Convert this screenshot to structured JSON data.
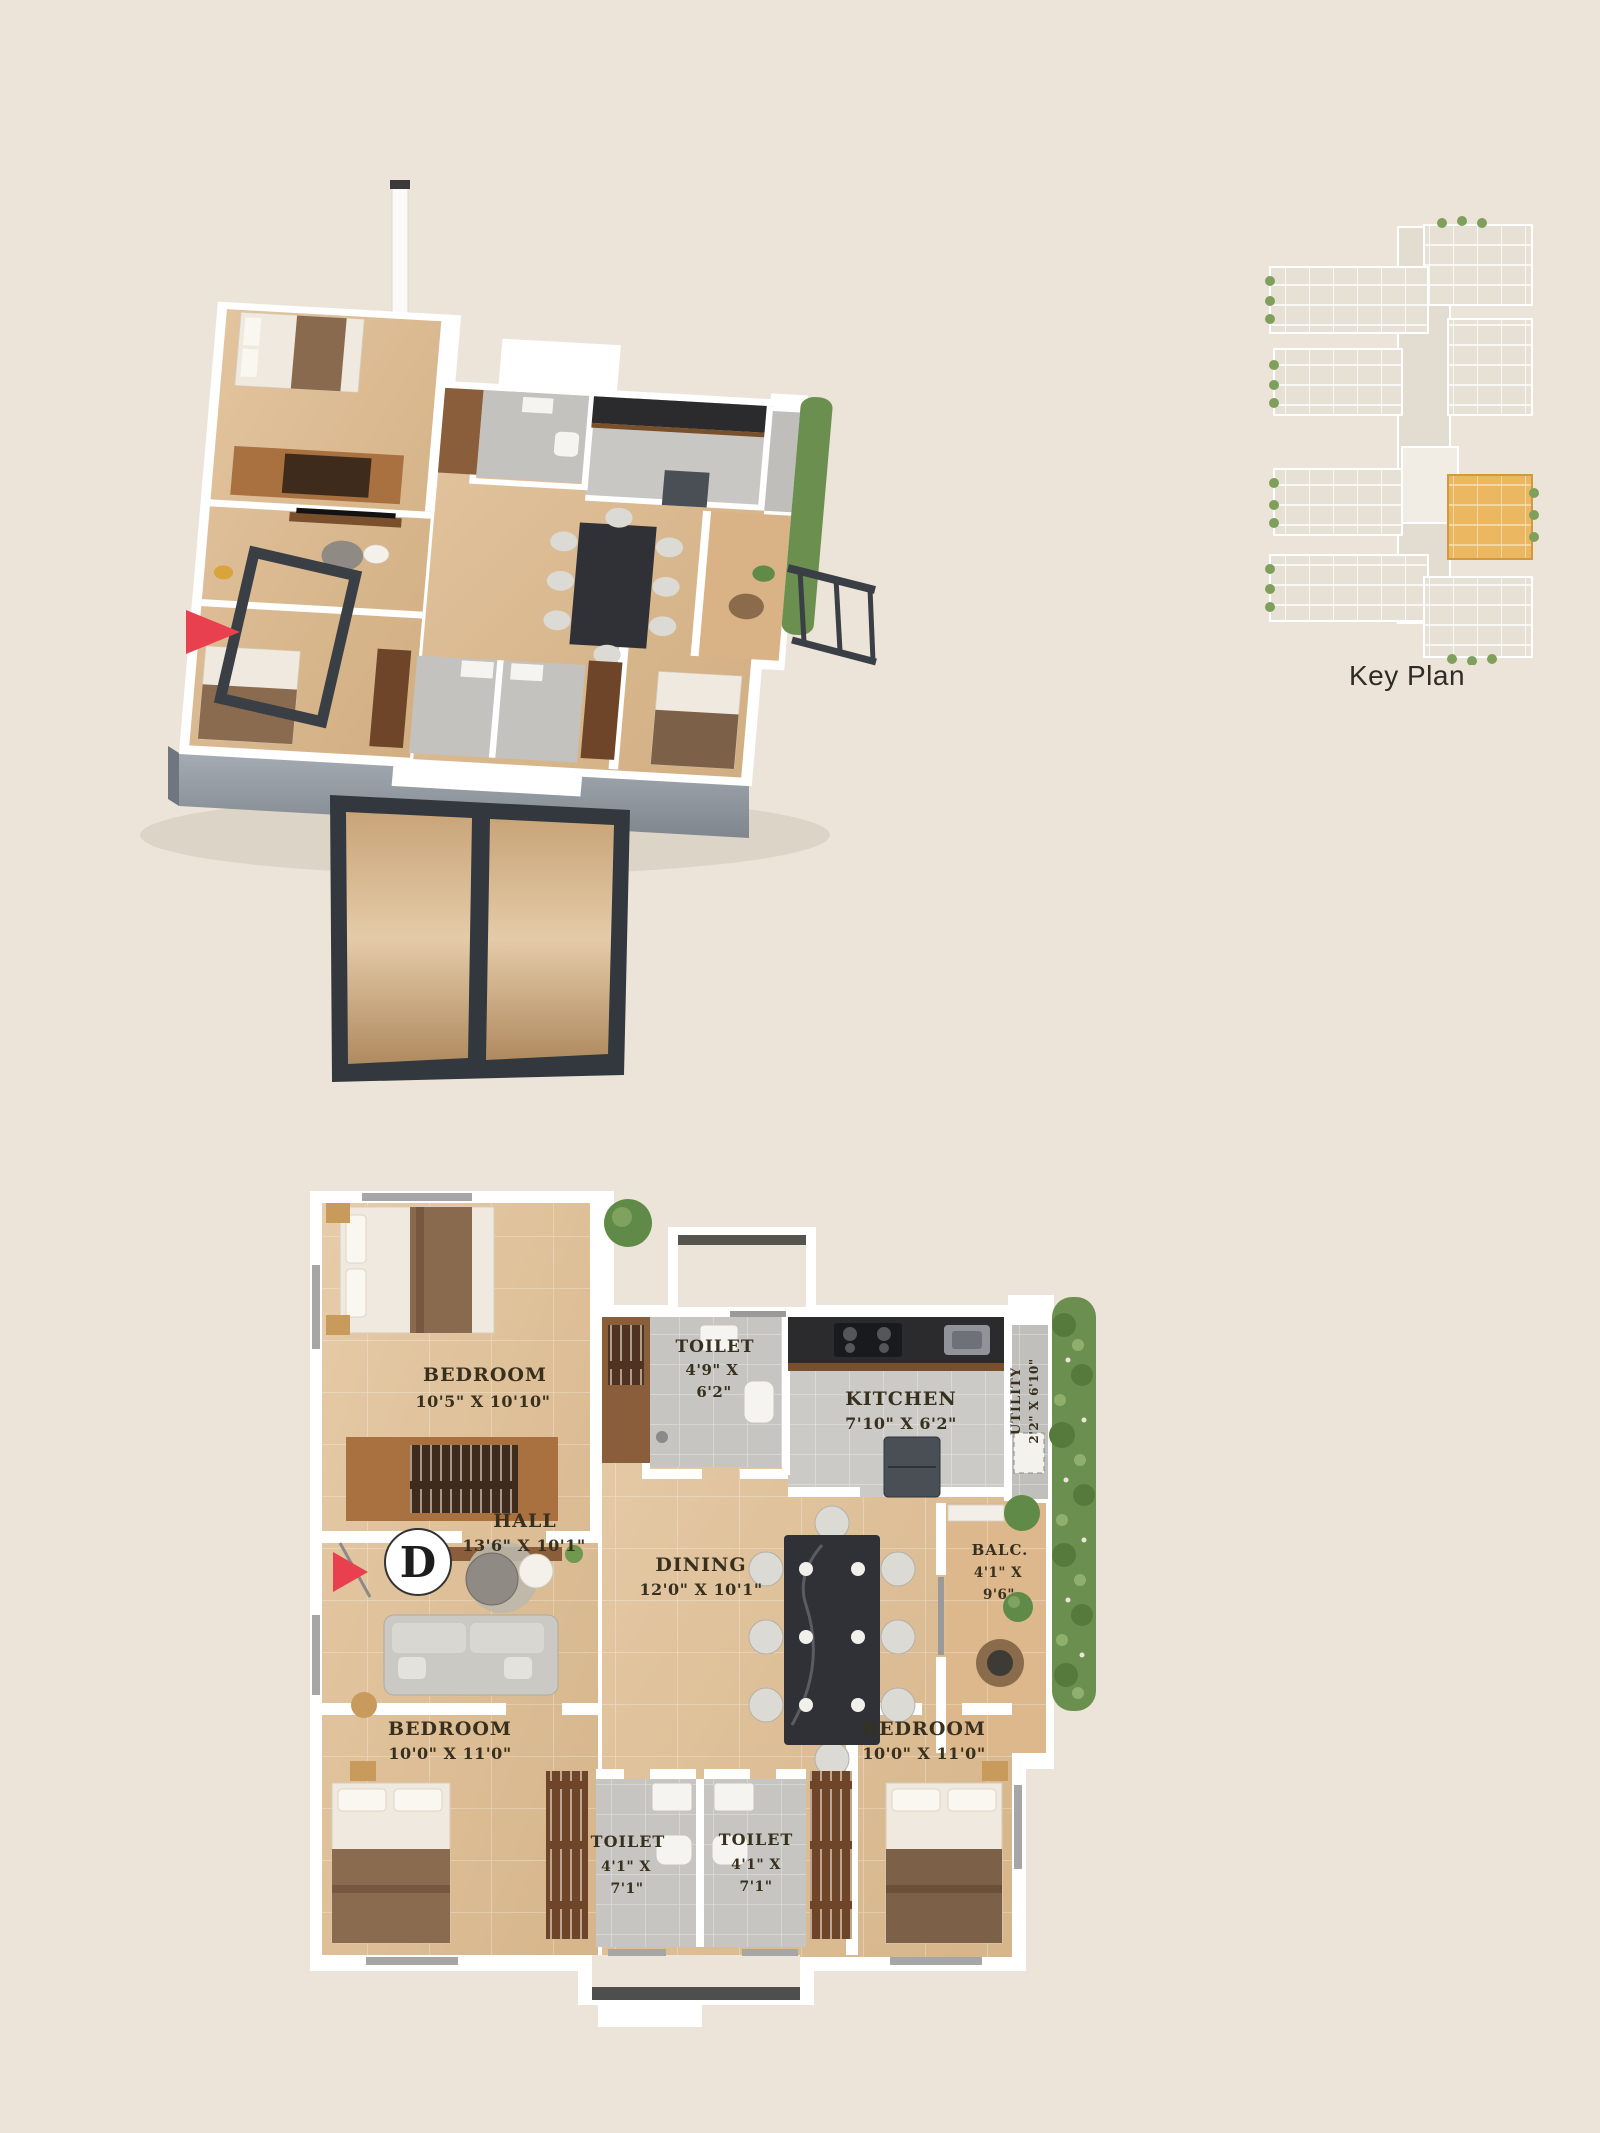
{
  "page": {
    "background": "#EDE4D9"
  },
  "key_plan": {
    "caption": "Key Plan",
    "highlight_color": "#EBB761"
  },
  "marker": {
    "unit_letter": "D",
    "color": "#E8404F"
  },
  "rooms": [
    {
      "name": "BEDROOM",
      "dims": "10'5\" X 10'10\""
    },
    {
      "name": "TOILET",
      "dims1": "4'9\" X",
      "dims2": "6'2\""
    },
    {
      "name": "KITCHEN",
      "dims": "7'10\" X 6'2\""
    },
    {
      "name": "UTILITY",
      "dims": "2'2\" X 6'10\""
    },
    {
      "name": "HALL",
      "dims": "13'6\" X 10'1\""
    },
    {
      "name": "DINING",
      "dims": "12'0\" X 10'1\""
    },
    {
      "name": "BALC.",
      "dims1": "4'1\" X",
      "dims2": "9'6\""
    },
    {
      "name": "BEDROOM",
      "dims": "10'0\" X 11'0\""
    },
    {
      "name": "TOILET",
      "dims1": "4'1\" X",
      "dims2": "7'1\""
    },
    {
      "name": "TOILET",
      "dims1": "4'1\" X",
      "dims2": "7'1\""
    },
    {
      "name": "BEDROOM",
      "dims": "10'0\" X 11'0\""
    }
  ]
}
